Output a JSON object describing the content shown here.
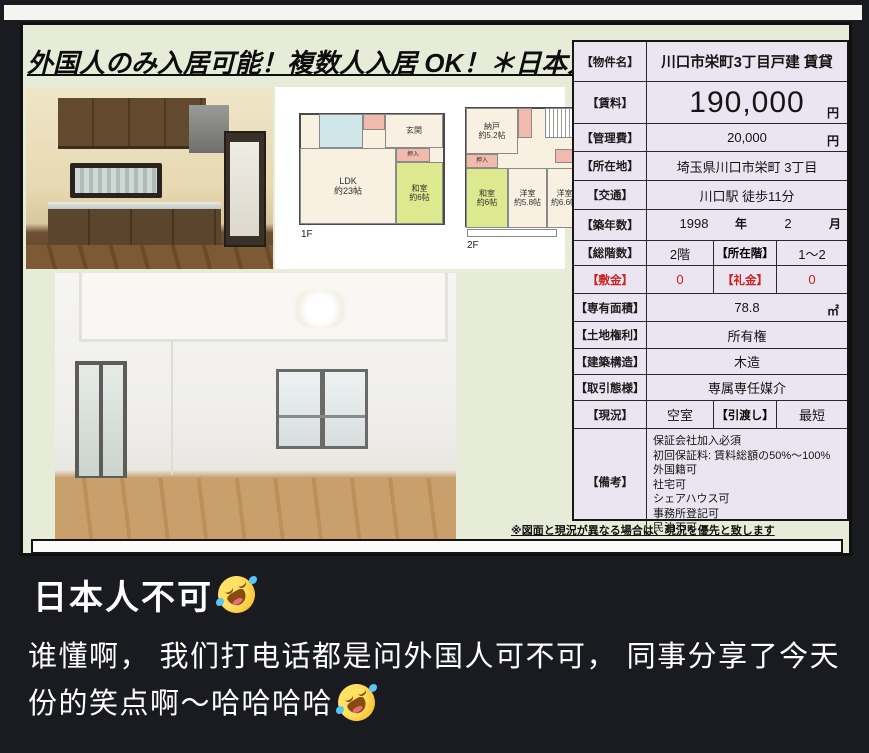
{
  "flyer": {
    "title": "外国人のみ入居可能！複数人入居 OK！＊日本人不可",
    "note": "※図面と現況が異なる場合は、現況を優先と致します"
  },
  "floorplan": {
    "floor1_label": "1F",
    "floor2_label": "2F",
    "f1_ldk": "LDK\n約23帖",
    "f1_washitsu": "和室\n約6帖",
    "f1_oshiire": "押入",
    "f1_genkan": "玄関",
    "f2_nando": "納戸\n約5.2帖",
    "f2_washitsu": "和室\n約6帖",
    "f2_yoshitsu1": "洋室\n約5.8帖",
    "f2_yoshitsu2": "洋室\n約6.6帖",
    "f2_oshiire": "押入"
  },
  "spec_table": {
    "property_name": {
      "label": "【物件名】",
      "value": "川口市栄町3丁目戸建 賃貸"
    },
    "rent": {
      "label": "【賃料】",
      "value": "190,000",
      "unit": "円"
    },
    "management_fee": {
      "label": "【管理費】",
      "value": "20,000",
      "unit": "円"
    },
    "location": {
      "label": "【所在地】",
      "value": "埼玉県川口市栄町 3丁目"
    },
    "transport": {
      "label": "【交通】",
      "value": "川口駅 徒歩11分"
    },
    "built": {
      "label": "【築年数】",
      "year_value": "1998",
      "year_unit": "年",
      "month_value": "2",
      "month_unit": "月"
    },
    "floors": {
      "label": "【総階数】",
      "value": "2階",
      "label2": "【所在階】",
      "value2": "1～2"
    },
    "deposit": {
      "label": "【敷金】",
      "value": "0",
      "label2": "【礼金】",
      "value2": "0"
    },
    "area": {
      "label": "【専有面積】",
      "value": "78.8",
      "unit": "㎡"
    },
    "land_rights": {
      "label": "【土地権利】",
      "value": "所有権"
    },
    "structure": {
      "label": "【建築構造】",
      "value": "木造"
    },
    "transaction": {
      "label": "【取引態様】",
      "value": "専属専任媒介"
    },
    "status": {
      "label": "【現況】",
      "value": "空室",
      "label2": "【引渡し】",
      "value2": "最短"
    },
    "remarks": {
      "label": "【備考】",
      "value": "保証会社加入必須\n初回保証料: 賃料総額の50%～100%\n外国籍可\n社宅可\nシェアハウス可\n事務所登記可\n民泊不可"
    }
  },
  "caption": {
    "line1": "日本人不可",
    "line2": "谁懂啊， 我们打电话都是问外国人可不可， 同事分享了今天份的笑点啊～哈哈哈哈"
  },
  "icons": {
    "rofl_emoji": "🤣"
  },
  "colors": {
    "page_background": "#1a1a21",
    "sheet_background": "#e7ecd8",
    "table_cell_background": "#eae5f0",
    "alert_red": "#cf1f1f",
    "caption_text": "#ffffff"
  }
}
